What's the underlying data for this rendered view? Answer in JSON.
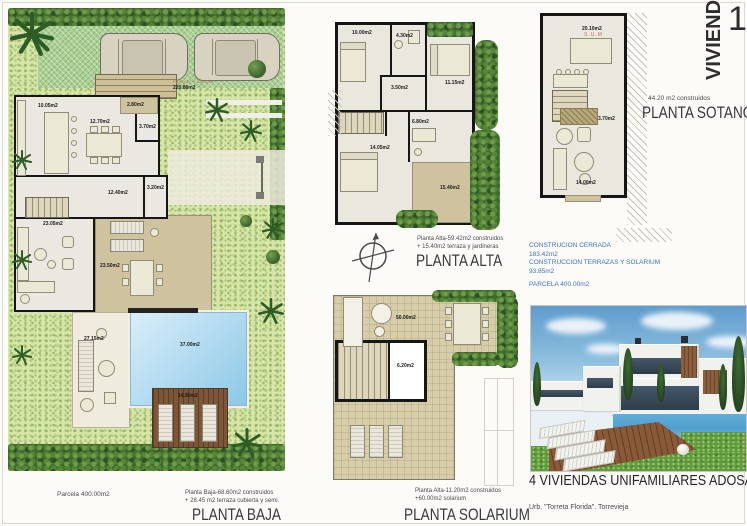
{
  "header": {
    "vivienda": "VIVIENDA",
    "number": "1"
  },
  "plans": {
    "baja": {
      "title": "PLANTA BAJA",
      "caption_line1": "Planta Baja-68.60m2 construidos",
      "caption_line2": "+ 28.45 m2 terraza cubierta y semi.",
      "parcela_caption": "Parcela 400.00m2",
      "garden_label": "PARQUE Y JARDIN",
      "garden_area": "220.86m2",
      "rooms": {
        "cocina": "10.05m2",
        "comedor": "12.70m2",
        "terraza_sup": "2.80m2",
        "aseo": "3.70m2",
        "dormitorio": "12.40m2",
        "trastero": "3.20m2",
        "estar": "23.05m2",
        "porche": "23.50m2",
        "terraza_piscina": "27.15m2",
        "piscina": "37.00m2",
        "deck": "14.80m2"
      }
    },
    "alta": {
      "title": "PLANTA ALTA",
      "caption_line1": "Planta Alta-59.42m2 construidos",
      "caption_line2": "+ 15.40m2 terraza y jardineras",
      "rooms": {
        "dormitorio2": "10.00m2",
        "bano1": "4.30m2",
        "dormitorio1": "11.15m2",
        "distribuidor": "3.50m2",
        "dormitorio_ppal": "14.05m2",
        "bano2": "6.80m2",
        "terraza": "15.40m2"
      }
    },
    "solarium": {
      "title": "PLANTA SOLARIUM",
      "caption_line1": "Planta Alta-11.20m2 construidos",
      "caption_line2": "+60.00m2 solarium",
      "rooms": {
        "solarium": "50.00m2",
        "escalera": "6.20m2"
      }
    },
    "sotano": {
      "title": "PLANTA SOTANO",
      "caption": "44.20 m2 construidos",
      "rooms": {
        "sum_label": "S.U.M",
        "sum": "20.10m2",
        "escalera": "3.70m2",
        "sala": "14.00m2"
      }
    }
  },
  "info": {
    "line1": "CONSTRUCION CERRADA",
    "line2": "183.42m2",
    "line3": "CONSTRUCCION TERRAZAS Y SOLARIUM",
    "line4": "93.85m2",
    "line5": "PARCELA 400.00m2"
  },
  "footer": {
    "title": "4 VIVIENDAS UNIFAMILIARES ADOSADA",
    "location": "Urb. \"Torreta Florida\".  Torrevieja"
  },
  "icons": {
    "compass": "compass-rose",
    "palm": "palm-tree"
  },
  "colors": {
    "garden_green": "#d7e6a8",
    "hedge_green": "#3b682e",
    "pool_blue": "#8cc8e6",
    "deck_brown": "#7d5637",
    "terrace_tan": "#cfc39f",
    "wall_black": "#161616",
    "label_red": "#c4705d",
    "info_blue": "#3f72b8",
    "title_gray": "#3a3a3a"
  }
}
